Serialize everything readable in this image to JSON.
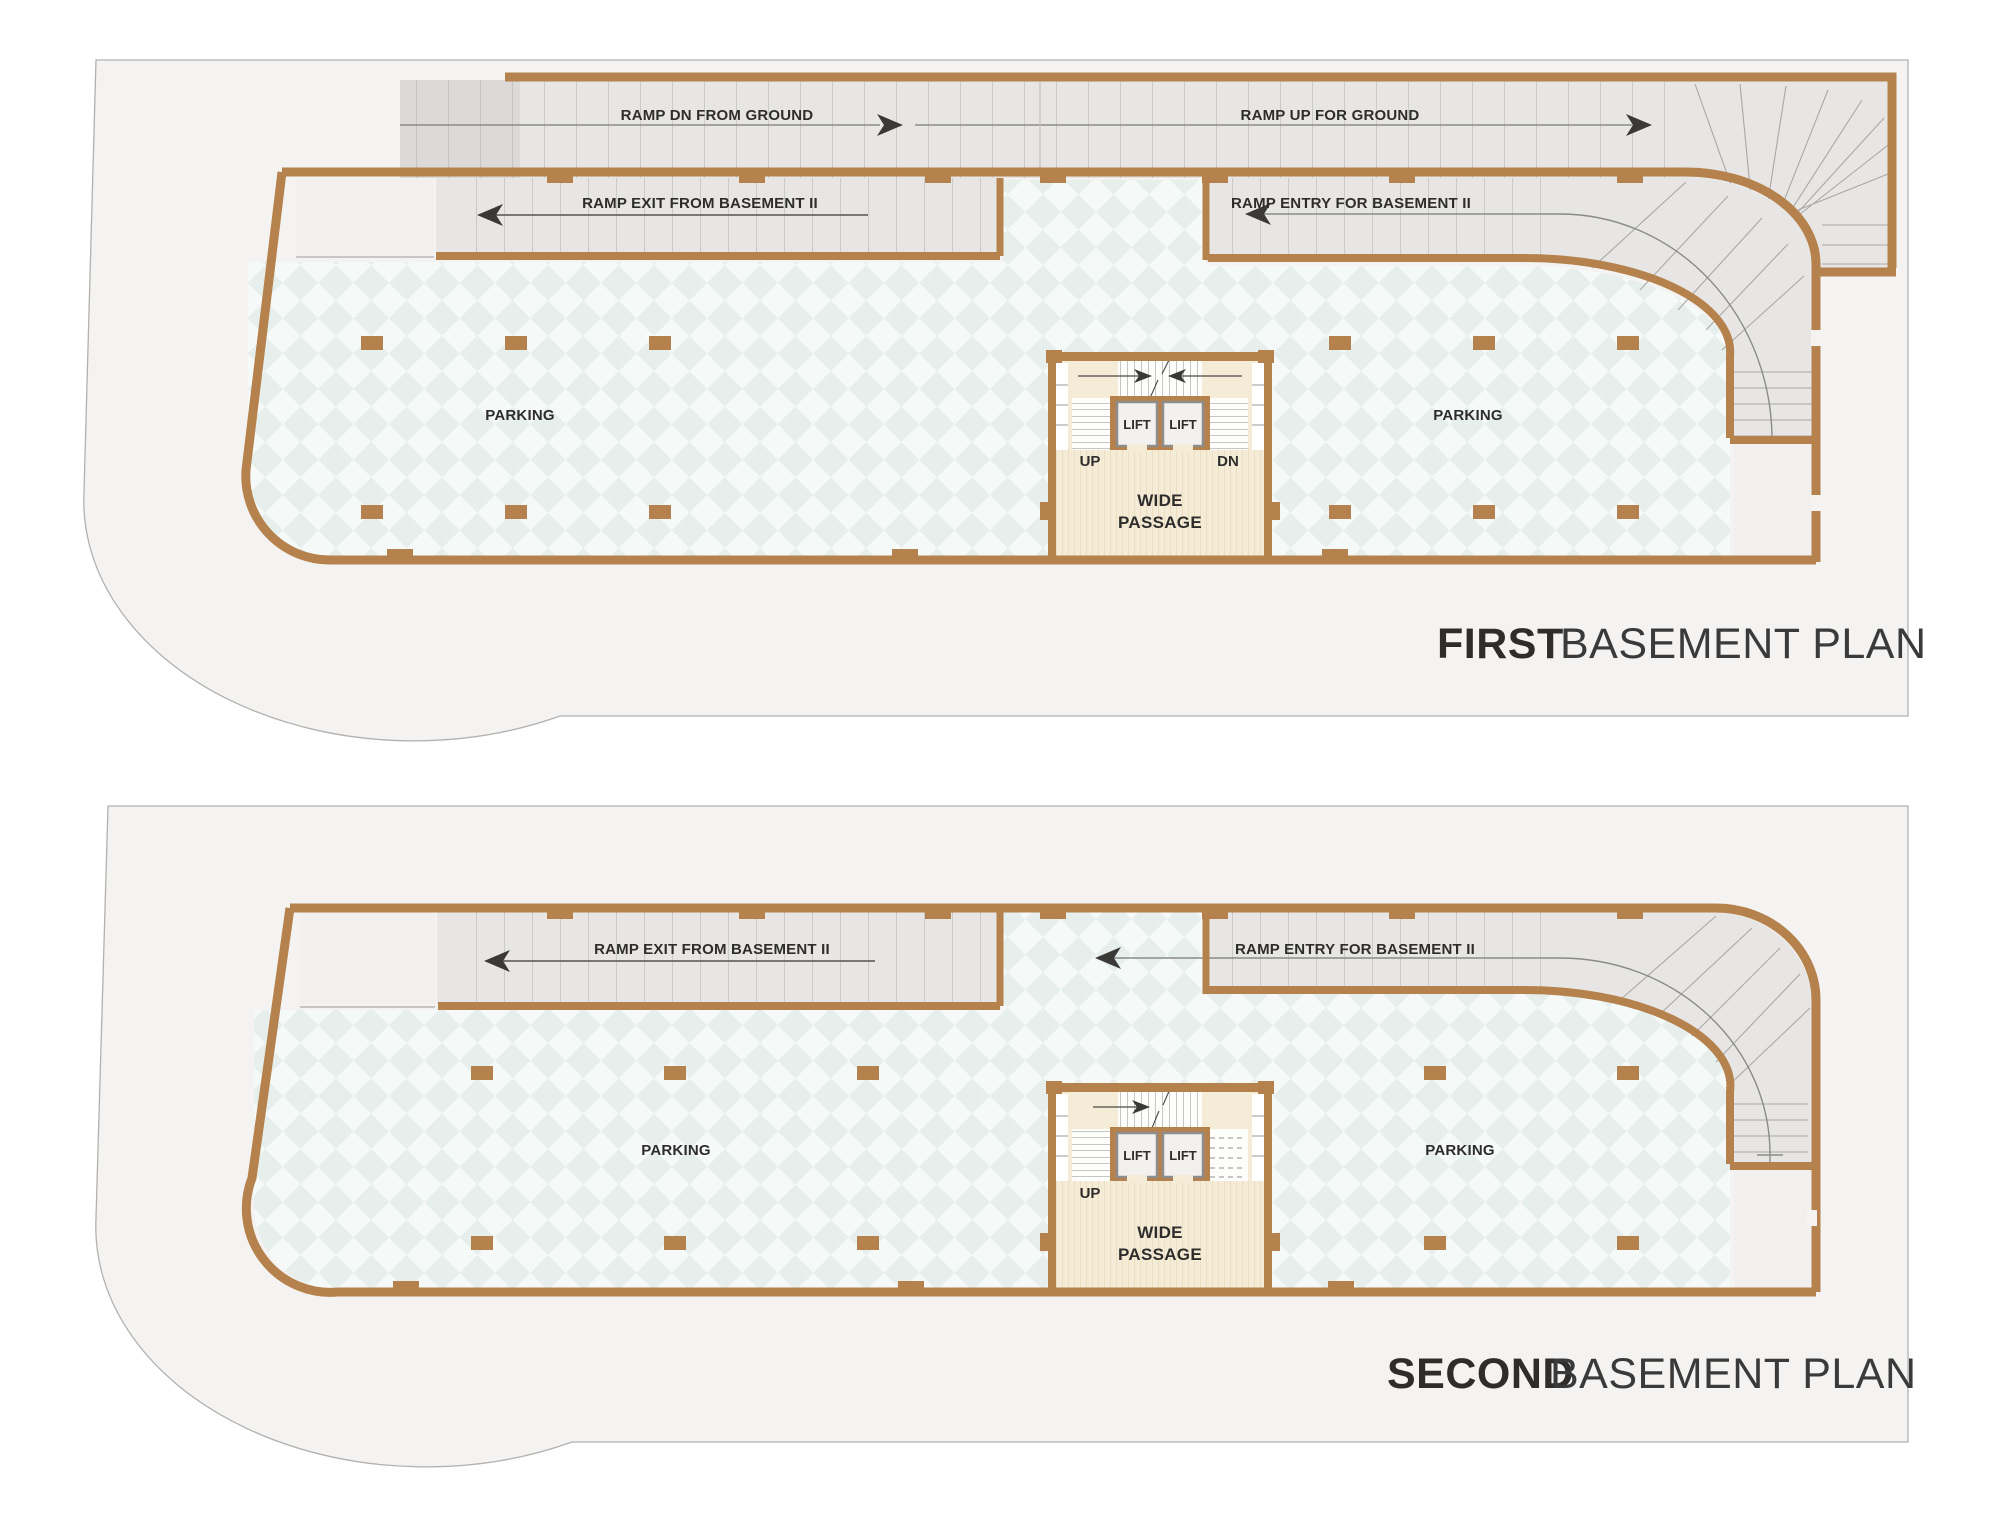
{
  "colors": {
    "accent_orange": "#d4581e",
    "wall_brown": "#b5814c",
    "site_gray": "#f4f3f1",
    "ramp_gray": "#e7e6e4",
    "floor_mint_dark": "#e7efed",
    "floor_mint_light": "#f5f9f8",
    "core_cream": "#f5ecd8",
    "text_dark": "#2e2d2b"
  },
  "plan1": {
    "title_accent": "FIRST",
    "title_rest": "BASEMENT PLAN",
    "labels": {
      "ramp_dn": "RAMP DN FROM GROUND",
      "ramp_up": "RAMP UP FOR GROUND",
      "ramp_exit": "RAMP EXIT FROM BASEMENT II",
      "ramp_entry": "RAMP ENTRY FOR BASEMENT II",
      "parking_left": "PARKING",
      "parking_right": "PARKING",
      "lift_1": "LIFT",
      "lift_2": "LIFT",
      "up": "UP",
      "dn": "DN",
      "wide_line1": "WIDE",
      "wide_line2": "PASSAGE"
    }
  },
  "plan2": {
    "title_accent": "SECOND",
    "title_rest": "BASEMENT PLAN",
    "labels": {
      "ramp_exit": "RAMP EXIT FROM BASEMENT II",
      "ramp_entry": "RAMP ENTRY FOR BASEMENT II",
      "parking_left": "PARKING",
      "parking_right": "PARKING",
      "lift_1": "LIFT",
      "lift_2": "LIFT",
      "up": "UP",
      "wide_line1": "WIDE",
      "wide_line2": "PASSAGE"
    }
  }
}
